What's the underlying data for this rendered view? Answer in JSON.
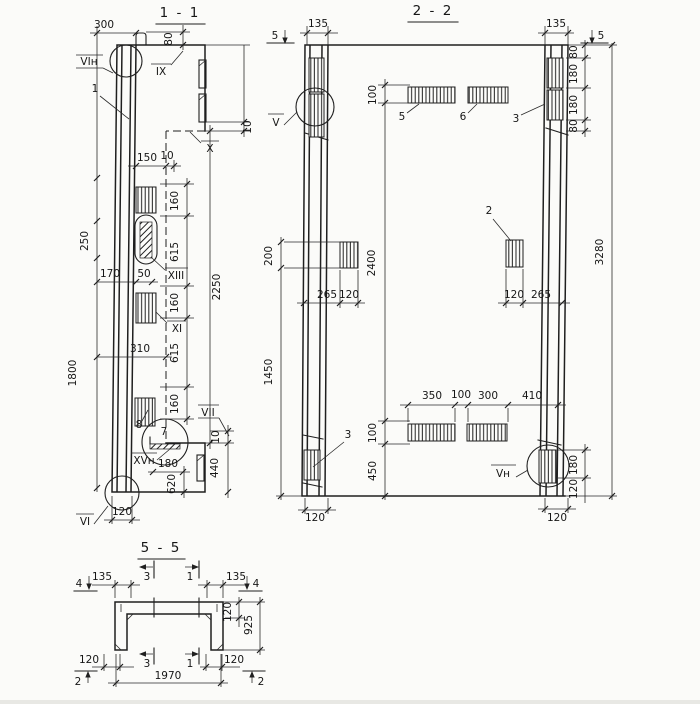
{
  "page": {
    "background": "#fbfbf9",
    "ink": "#1f1f1f"
  },
  "sections": {
    "s1": {
      "title": "1 - 1",
      "dims": {
        "w300": "300",
        "h80": "80",
        "w150": "150",
        "w10": "10",
        "g10": "10",
        "s160a": "160",
        "s615a": "615",
        "s160b": "160",
        "s615b": "615",
        "s160c": "160",
        "h2250": "2250",
        "h250": "250",
        "h1800": "1800",
        "w170": "170",
        "w50": "50",
        "w310": "310",
        "w180": "180",
        "h620": "620",
        "h440": "440",
        "g10b": "10",
        "w120": "120"
      },
      "refs": {
        "vin": "VIн",
        "ix": "IX",
        "x": "X",
        "xiii": "XIII",
        "xi": "XI",
        "vii": "VII",
        "xvn": "XVн",
        "vi": "VI"
      },
      "items": {
        "i1": "1",
        "i7": "7",
        "i8": "8"
      }
    },
    "s2": {
      "title": "2 - 2",
      "cuts": {
        "c5l": "5",
        "c5r": "5"
      },
      "dims": {
        "w135l": "135",
        "w135r": "135",
        "h80a": "80",
        "h180a": "180",
        "h180b": "180",
        "h80b": "80",
        "h3280": "3280",
        "h100t": "100",
        "h2400": "2400",
        "h100b": "100",
        "h450": "450",
        "h200": "200",
        "h1450": "1450",
        "w265l": "265",
        "w120l": "120",
        "w120r": "120",
        "w265r": "265",
        "w350": "350",
        "w100": "100",
        "w300": "300",
        "w410": "410",
        "h180r": "180",
        "h120r": "120",
        "w120bl": "120",
        "w120br": "120"
      },
      "refs": {
        "v": "V",
        "vn": "Vн"
      },
      "items": {
        "i2": "2",
        "i3t": "3",
        "i3b": "3",
        "i5": "5",
        "i6": "6"
      }
    },
    "s5": {
      "title": "5 - 5",
      "cuts": {
        "c4l": "4",
        "c4r": "4",
        "c3t": "3",
        "c1t": "1",
        "c3b": "3",
        "c1b": "1",
        "c2l": "2",
        "c2r": "2"
      },
      "dims": {
        "w135l": "135",
        "w135r": "135",
        "h120": "120",
        "h925": "925",
        "w120l": "120",
        "w120r": "120",
        "w1970": "1970"
      }
    }
  }
}
